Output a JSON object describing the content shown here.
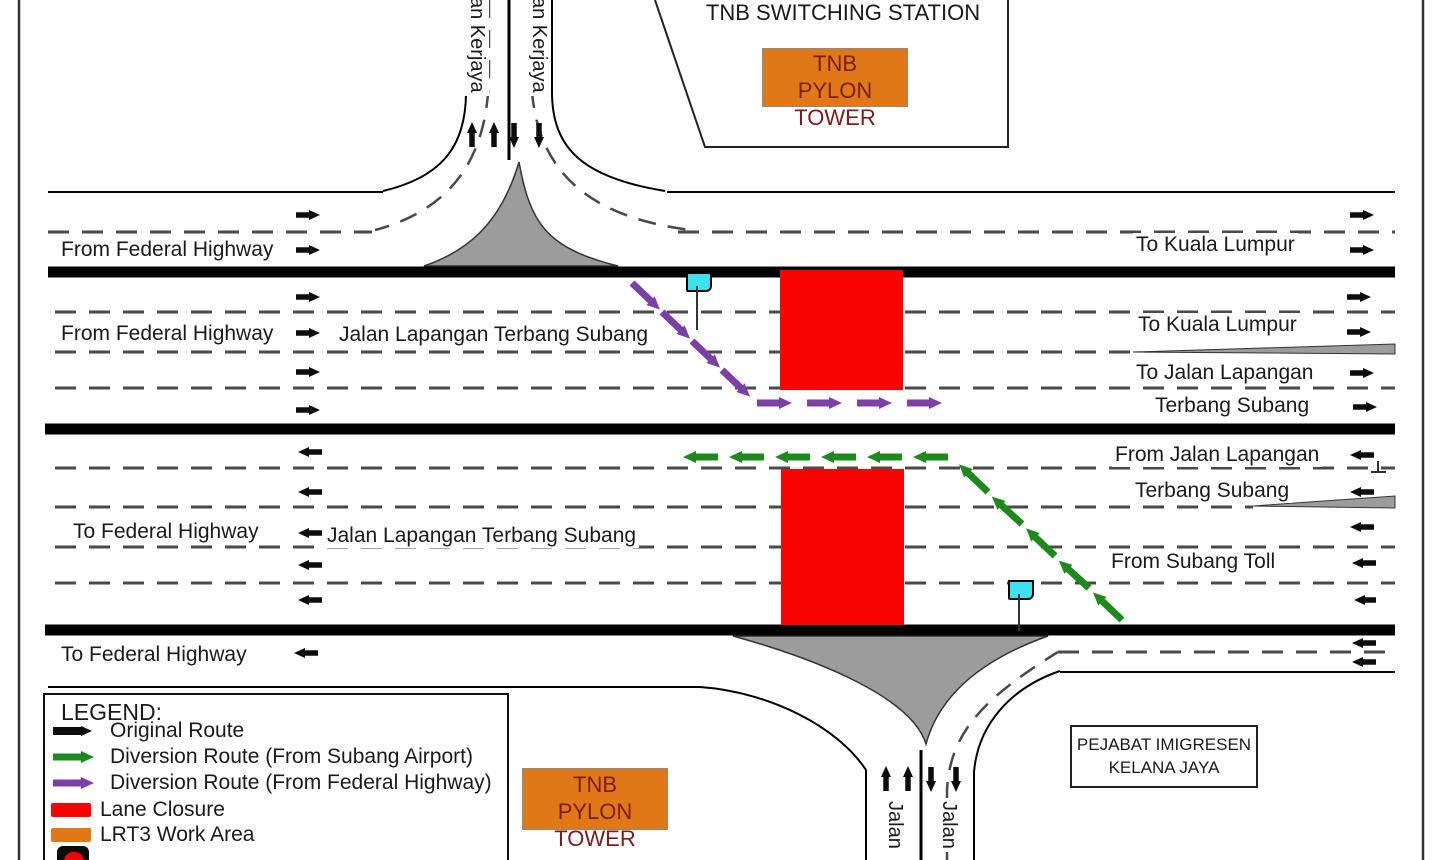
{
  "title_blocks": {
    "tnb_switching_station": "TNB SWITCHING STATION",
    "tnb_pylon_tower_line1": "TNB",
    "tnb_pylon_tower_line2": "PYLON TOWER",
    "pejabat_line1": "PEJABAT IMIGRESEN",
    "pejabat_line2": "KELANA JAYA"
  },
  "streets": {
    "top_vertical_left": "an Kerjaya",
    "top_vertical_right": "an Kerjaya",
    "bottom_vertical_left": "Jalan",
    "bottom_vertical_right": "Jalan",
    "from_federal_highway_1": "From Federal Highway",
    "from_federal_highway_2": "From Federal Highway",
    "jalan_lapangan_upper": "Jalan Lapangan Terbang Subang",
    "jalan_lapangan_lower": "Jalan Lapangan Terbang Subang",
    "to_kuala_lumpur_1": "To Kuala Lumpur",
    "to_kuala_lumpur_2": "To Kuala Lumpur",
    "to_jalan_lapangan_line1": "To Jalan Lapangan",
    "to_jalan_lapangan_line2": "Terbang Subang",
    "from_jalan_lapangan_line1": "From Jalan Lapangan",
    "from_jalan_lapangan_line2": "Terbang Subang",
    "from_subang_toll": "From Subang Toll",
    "to_federal_highway_1": "To Federal Highway",
    "to_federal_highway_2": "To Federal Highway"
  },
  "legend": {
    "title": "LEGEND:",
    "items": [
      {
        "label": "Original Route",
        "symbol": "black-arrow"
      },
      {
        "label": "Diversion Route (From Subang Airport)",
        "symbol": "green-arrow"
      },
      {
        "label": "Diversion  Route (From Federal Highway)",
        "symbol": "purple-arrow"
      },
      {
        "label": "Lane Closure",
        "symbol": "red-swatch"
      },
      {
        "label": "LRT3 Work Area",
        "symbol": "orange-swatch"
      },
      {
        "label": "",
        "symbol": "traffic-light-partial"
      }
    ]
  },
  "colors": {
    "closure": "#F80400",
    "work_area": "#E07818",
    "diversion_green": "#1E8A1E",
    "diversion_purple": "#7B3FA6",
    "flag_cyan": "#3CE3EE",
    "gore_gray": "#9C9C9C"
  }
}
